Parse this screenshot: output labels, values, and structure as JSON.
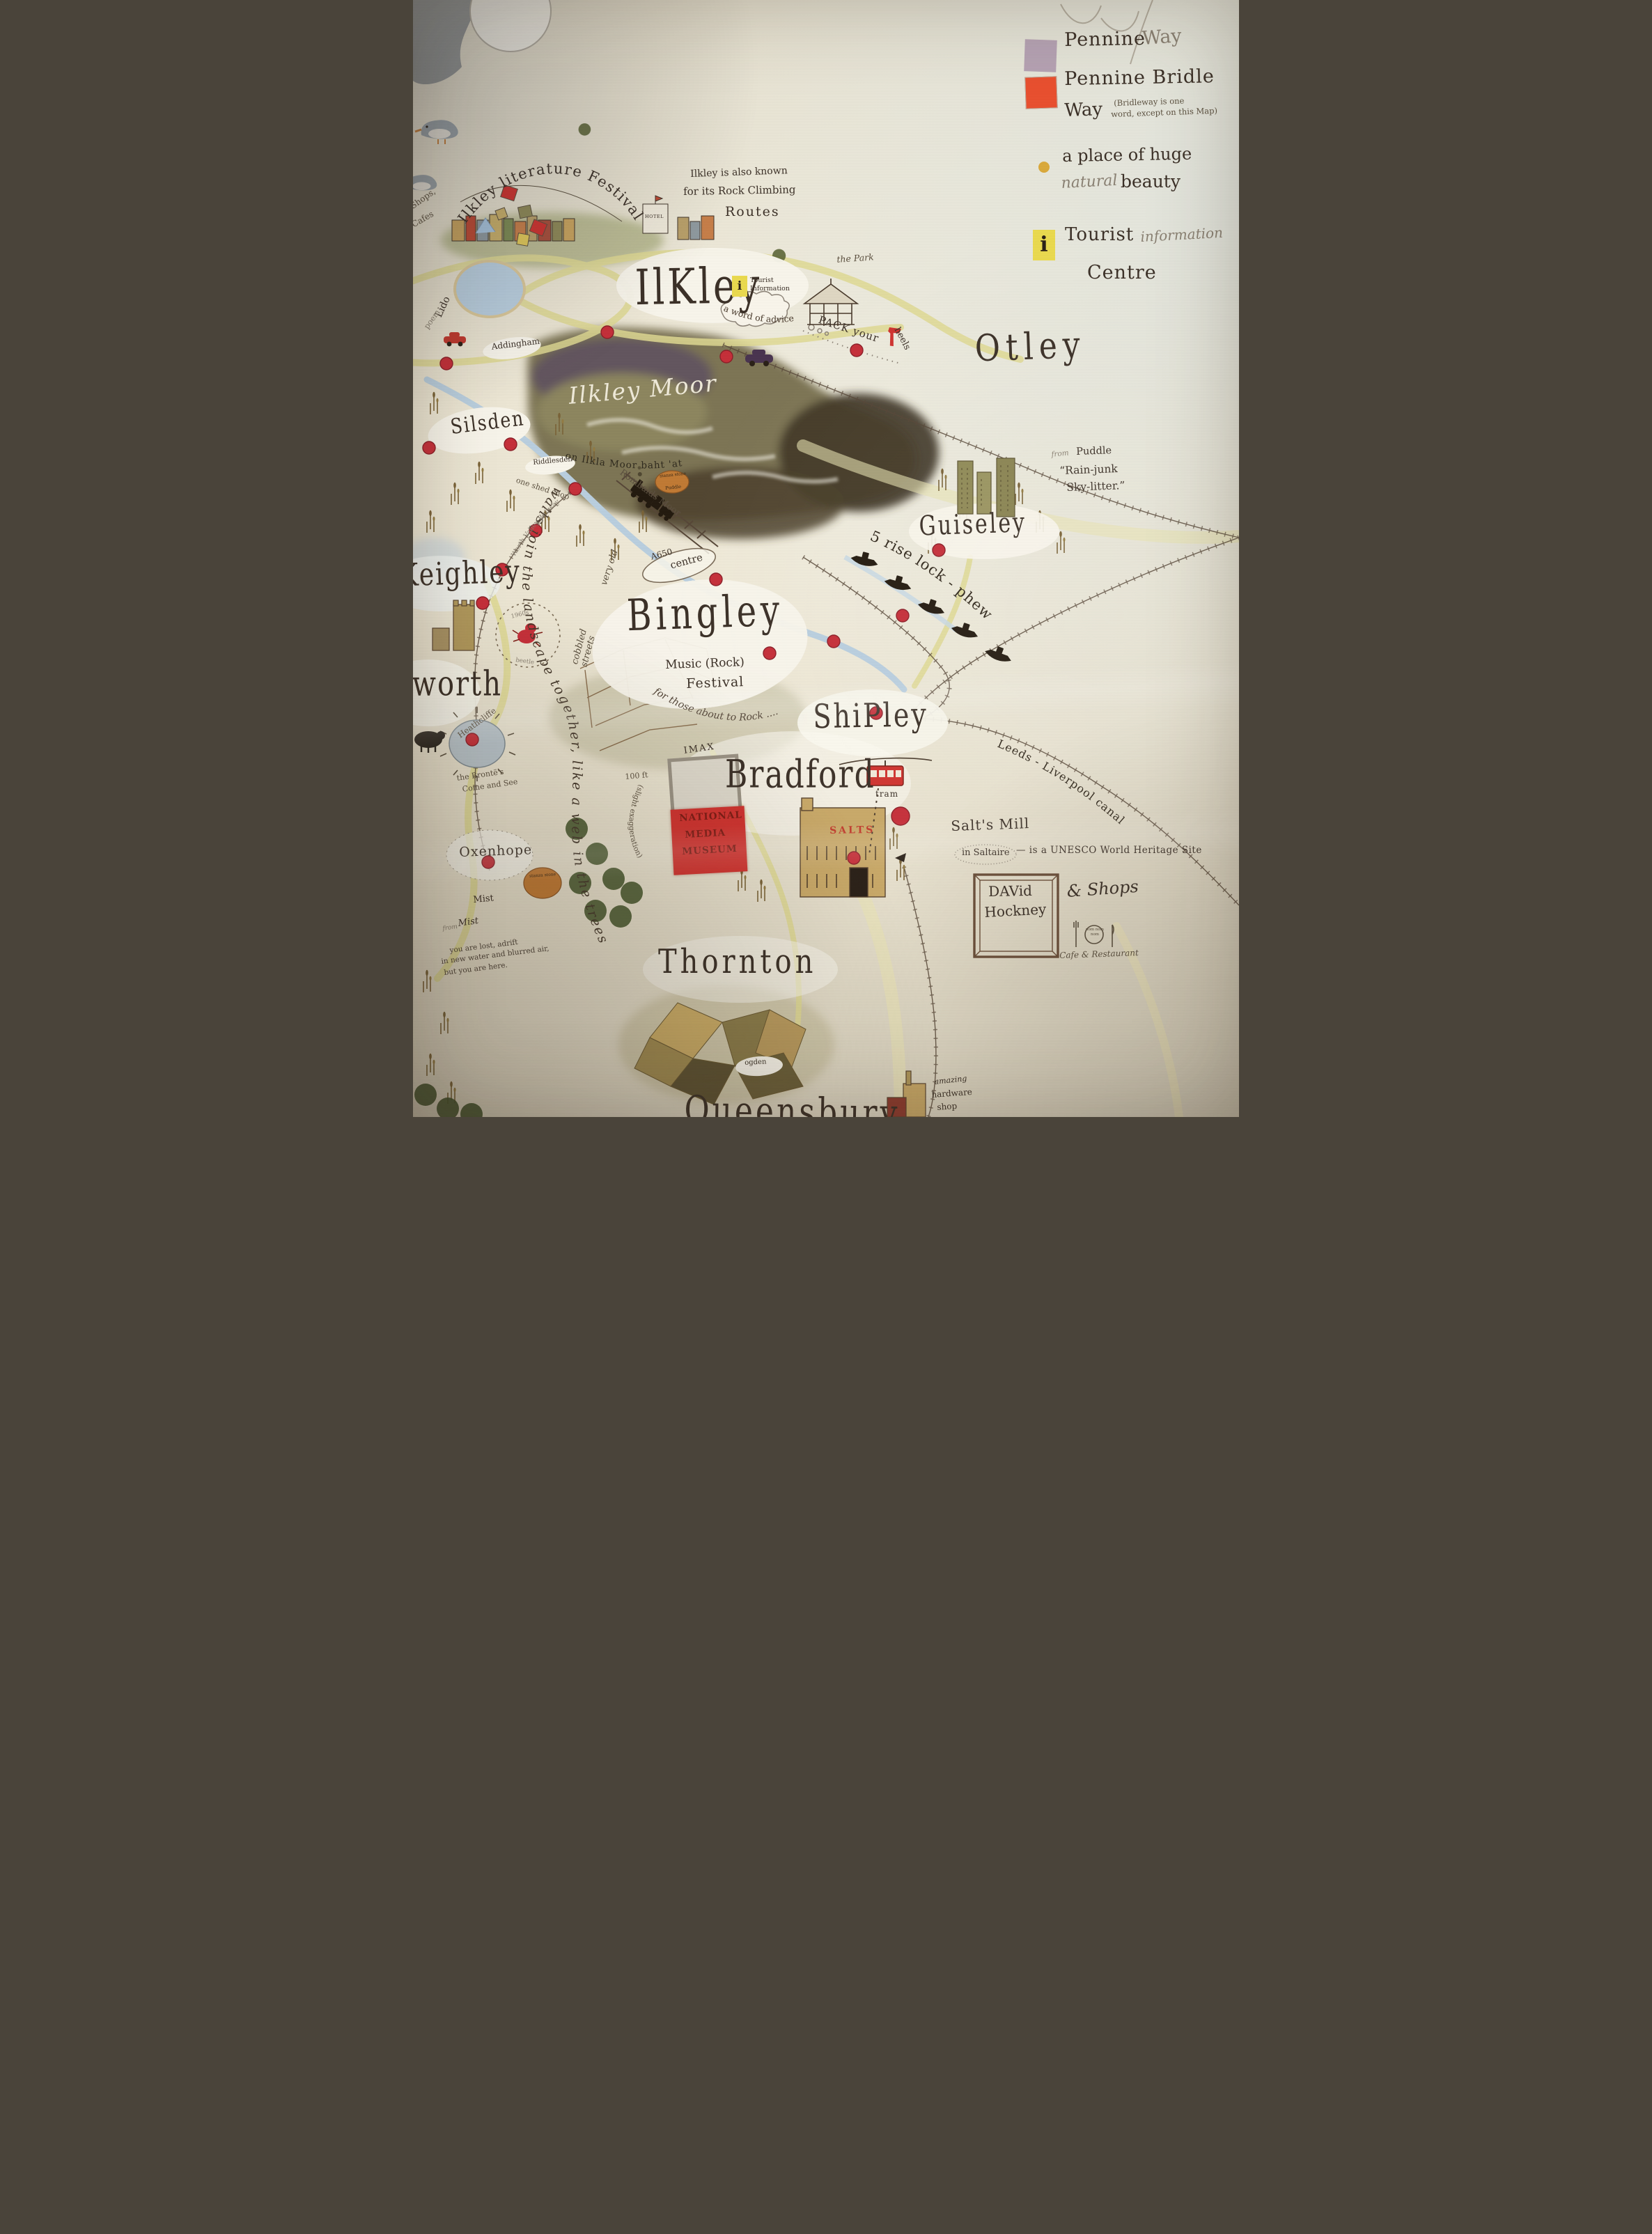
{
  "colors": {
    "accent_red": "#c5303a",
    "road_yellow": "#ded893",
    "water_blue": "#b9cede",
    "swatch_lilac": "#b5a2b3",
    "swatch_orange": "#e85030",
    "icon_yellow": "#e9d94f",
    "ink": "#3c3128"
  },
  "legend": {
    "pennine": "Pennine",
    "way_pencil": "Way",
    "pennine_bridle": "Pennine Bridle",
    "way2": "Way",
    "note1": "(Bridleway is one",
    "note2": "word, except on this Map)",
    "place_huge": "a place of huge",
    "natural": "natural",
    "beauty": "beauty",
    "info_i": "i",
    "tourist": "Tourist",
    "information": "information",
    "centre": "Centre"
  },
  "towns": {
    "ilkley": "IlKley",
    "otley": "Otley",
    "guiseley": "Guiseley",
    "silsden": "Silsden",
    "keighley": "Keighley",
    "haworth": "Haworth",
    "bingley": "Bingley",
    "shipley": "ShiPley",
    "bradford": "Bradford",
    "thornton": "Thornton",
    "queensbury": "Queensbury",
    "oxenhope": "Oxenhope",
    "addingham": "Addingham",
    "riddlesden": "Riddlesden",
    "ogden": "ogden"
  },
  "ilkley_area": {
    "festival_arc": "Ilkley literature Festival",
    "rock1": "Ilkley is also known",
    "rock2": "for its Rock Climbing",
    "rock3": "Routes",
    "shops": "Shops,",
    "cafes": "Cafes",
    "lido": "Lido",
    "poem": "poem",
    "hotel": "HOTEL",
    "the_park": "the Park",
    "tourist1": "Tourist",
    "tourist2": "Information",
    "info_i": "i",
    "advice": "a word of advice",
    "pack_your": "PACK your",
    "heels": "heels"
  },
  "moor": {
    "name": "Ilkley Moor",
    "baht_at": "on Ilkla Moor baht 'at",
    "rombalds": "Rombalds Moor",
    "stanza_stone": "stanza stone",
    "stanza_poem": "Puddle"
  },
  "otley_area": {
    "from": "from",
    "source": "Puddle",
    "quote1": "“Rain-junk",
    "quote2": "Sky-litter.”"
  },
  "west": {
    "one_shed_shop": "one shed shop",
    "worth_valley": "Worth Valley Railway",
    "beetle1": "1960s",
    "beetle2": "beetle",
    "heathcliffe": "Heathcliffe",
    "bronte1": "the Brontë's",
    "bronte2": "Come and See",
    "walls": "walls join the landscape together, like a web in the trees"
  },
  "bingley_area": {
    "very_old": "very old",
    "cobbled": "cobbled streets",
    "a650": "A650",
    "centre": "centre",
    "five_rise": "5 rise lock - phew",
    "music": "Music (Rock)",
    "festival": "Festival",
    "about_to_rock": "for those about to Rock ...."
  },
  "shipley_area": {
    "tram": "tram",
    "canal": "Leeds - Liverpool canal"
  },
  "bradford_area": {
    "imax": "IMAX",
    "height": "100 ft",
    "exaggeration": "(slight exaggeration)",
    "museum1": "NATIONAL",
    "museum2": "MEDIA",
    "museum3": "MUSEUM",
    "salts_sign": "SALTS"
  },
  "saltaire": {
    "mill": "Salt's Mill",
    "in_saltaire": "in Saltaire",
    "unesco": "— is a UNESCO World Heritage Site",
    "hockney1": "DAVid",
    "hockney2": "Hockney",
    "shops": "& Shops",
    "nom": "nom nom nom",
    "cafe": "Cafe & Restaurant"
  },
  "south": {
    "stanza_stone": "stanza stone",
    "mist": "Mist",
    "from_pencil": "from",
    "mist_script": "Mist",
    "lost1": "you are lost, adrift",
    "lost2": "in new water and blurred air,",
    "lost3": "but you are here.",
    "hardware1": "amazing",
    "hardware2": "hardware",
    "hardware3": "shop"
  }
}
